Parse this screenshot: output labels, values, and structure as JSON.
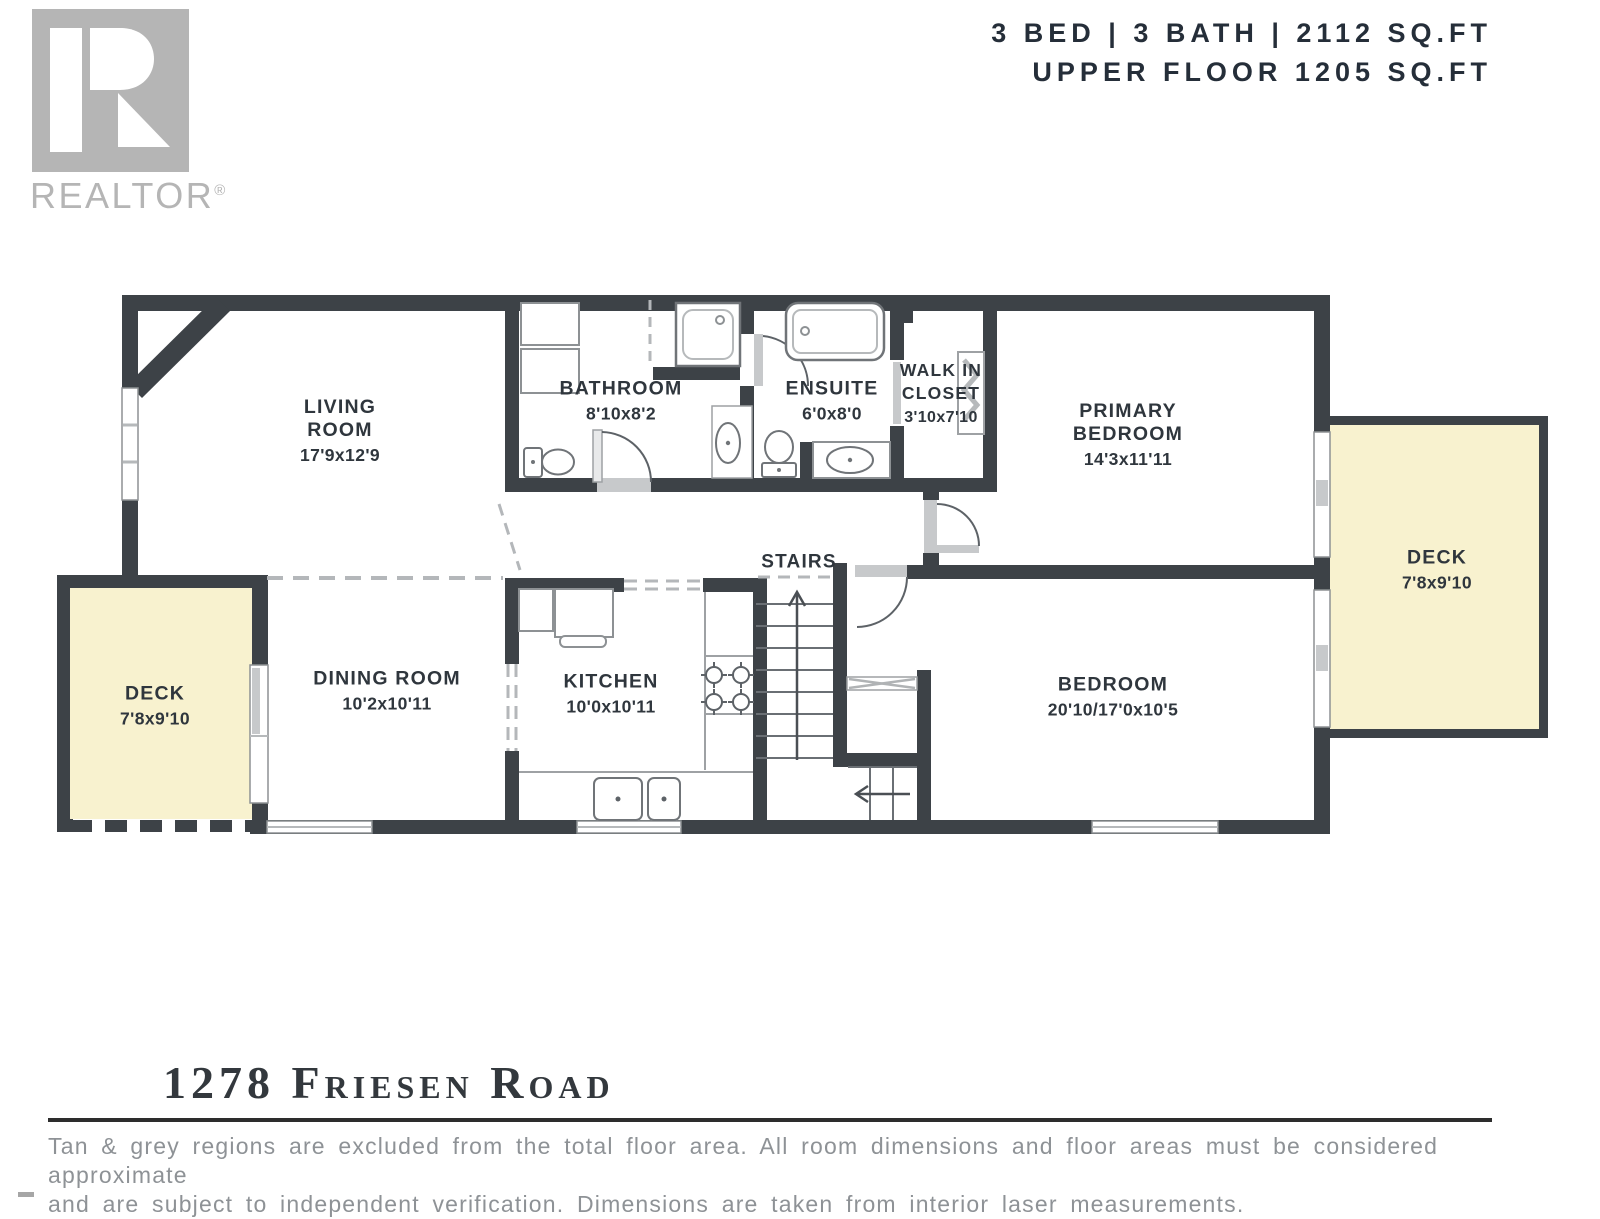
{
  "header": {
    "line1": "3 BED | 3 BATH | 2112 SQ.FT",
    "line2": "UPPER FLOOR 1205 SQ.FT"
  },
  "logo": {
    "brand": "REALTOR",
    "registered": "®"
  },
  "floorplan": {
    "rooms": {
      "living": {
        "name": "LIVING ROOM",
        "dims": "17'9x12'9"
      },
      "bathroom": {
        "name": "BATHROOM",
        "dims": "8'10x8'2"
      },
      "ensuite": {
        "name": "ENSUITE",
        "dims": "6'0x8'0"
      },
      "walk_in_closet": {
        "name": "WALK IN CLOSET",
        "dims": "3'10x7'10"
      },
      "primary_bedroom": {
        "name": "PRIMARY BEDROOM",
        "dims": "14'3x11'11"
      },
      "deck_right": {
        "name": "DECK",
        "dims": "7'8x9'10"
      },
      "deck_left": {
        "name": "DECK",
        "dims": "7'8x9'10"
      },
      "dining": {
        "name": "DINING ROOM",
        "dims": "10'2x10'11"
      },
      "kitchen": {
        "name": "KITCHEN",
        "dims": "10'0x10'11"
      },
      "stairs": {
        "name": "STAIRS"
      },
      "bedroom": {
        "name": "BEDROOM",
        "dims": "20'10/17'0x10'5"
      }
    },
    "colors": {
      "wall": "#3d4247",
      "deck_fill": "#f8f2cf",
      "fixture_grey": "#c7c9cb",
      "label_text": "#2f363d",
      "logo_grey": "#b5b5b5"
    }
  },
  "footer": {
    "address": "1278 Friesen Road",
    "disclaimer_line1": "Tan & grey regions are excluded from the total floor area. All room dimensions and floor areas must be considered approximate",
    "disclaimer_line2": "and are subject to independent verification. Dimensions are taken from interior laser measurements."
  }
}
